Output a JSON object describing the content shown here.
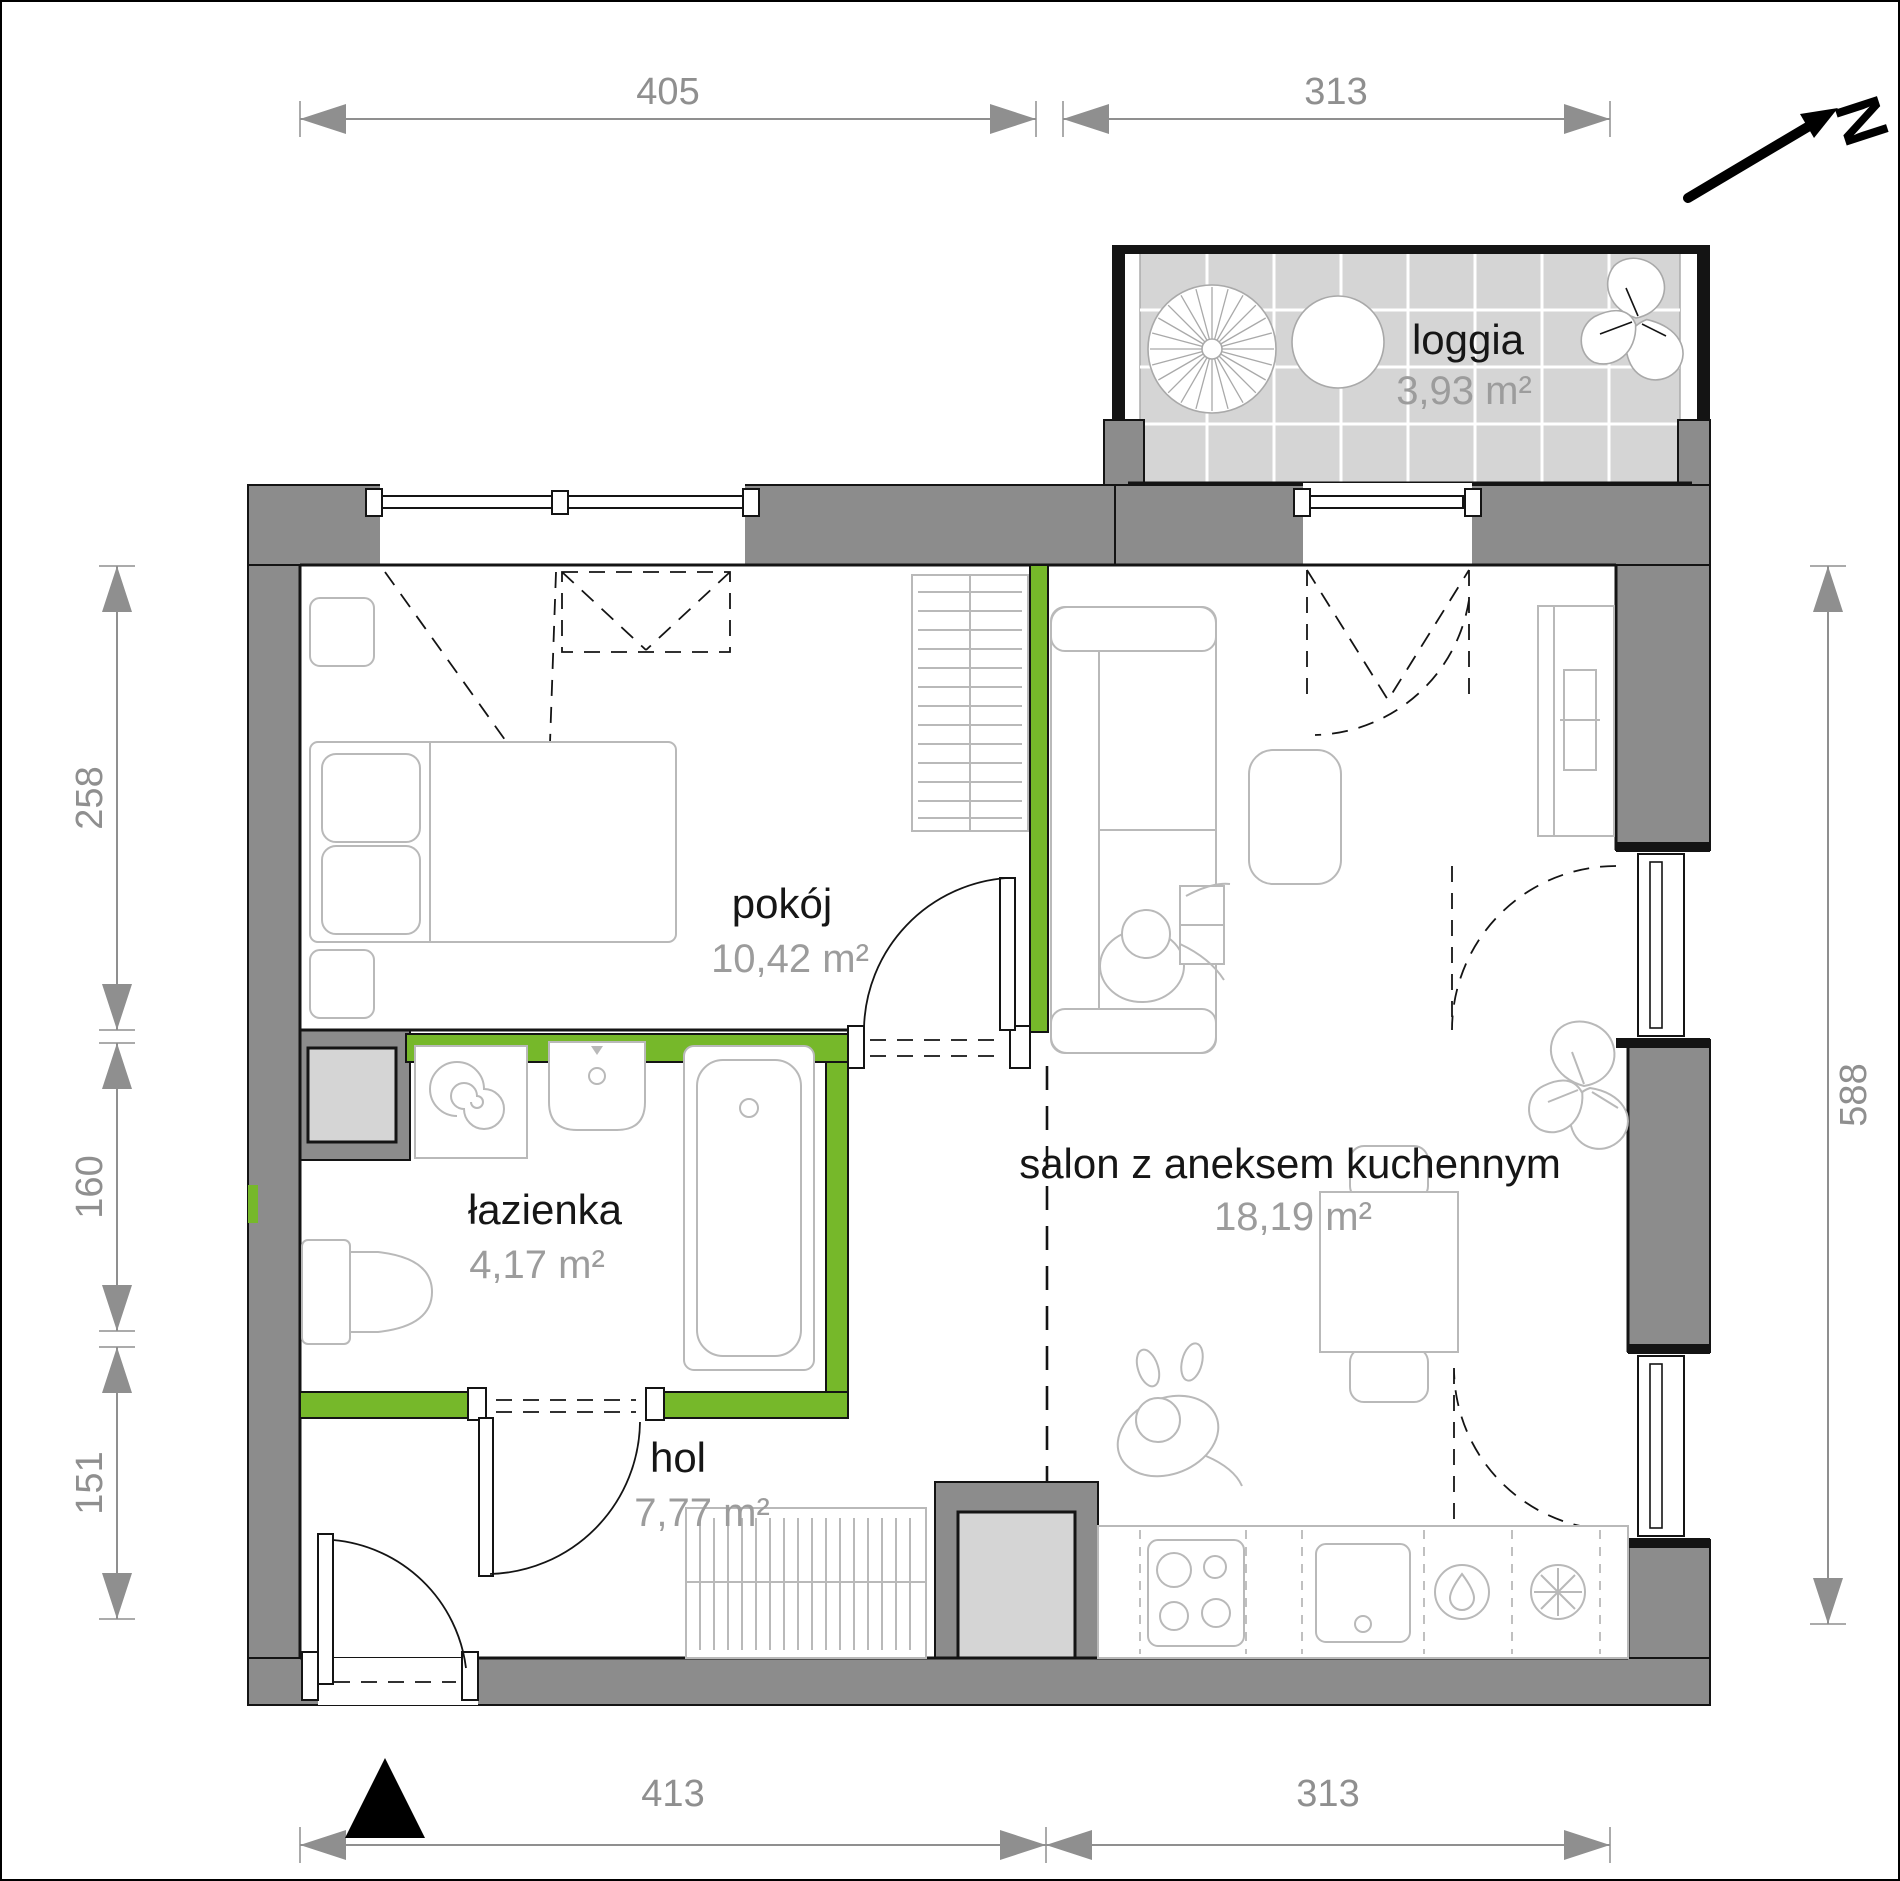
{
  "plan": {
    "rooms": [
      {
        "id": "pokoj",
        "name": "pokój",
        "area": "10,42 m²"
      },
      {
        "id": "lazienka",
        "name": "łazienka",
        "area": "4,17 m²"
      },
      {
        "id": "hol",
        "name": "hol",
        "area": "7,77 m²"
      },
      {
        "id": "salon",
        "name": "salon z aneksem kuchennym",
        "area": "18,19 m²"
      },
      {
        "id": "loggia",
        "name": "loggia",
        "area": "3,93 m²"
      }
    ],
    "dimensions_cm": {
      "top": [
        "405",
        "313"
      ],
      "left": [
        "258",
        "160",
        "151"
      ],
      "right": [
        "588"
      ],
      "bottom": [
        "413",
        "313"
      ]
    },
    "compass_letter": "N",
    "colors": {
      "accent_green": "#76b82a",
      "wall_gray": "#8c8c8c",
      "light_gray": "#d5d5d5",
      "dimension_gray": "#8f8f8f",
      "area_text_gray": "#9c9c9c",
      "furniture_line_gray": "#b9b9b9",
      "label_black": "#161616"
    }
  }
}
